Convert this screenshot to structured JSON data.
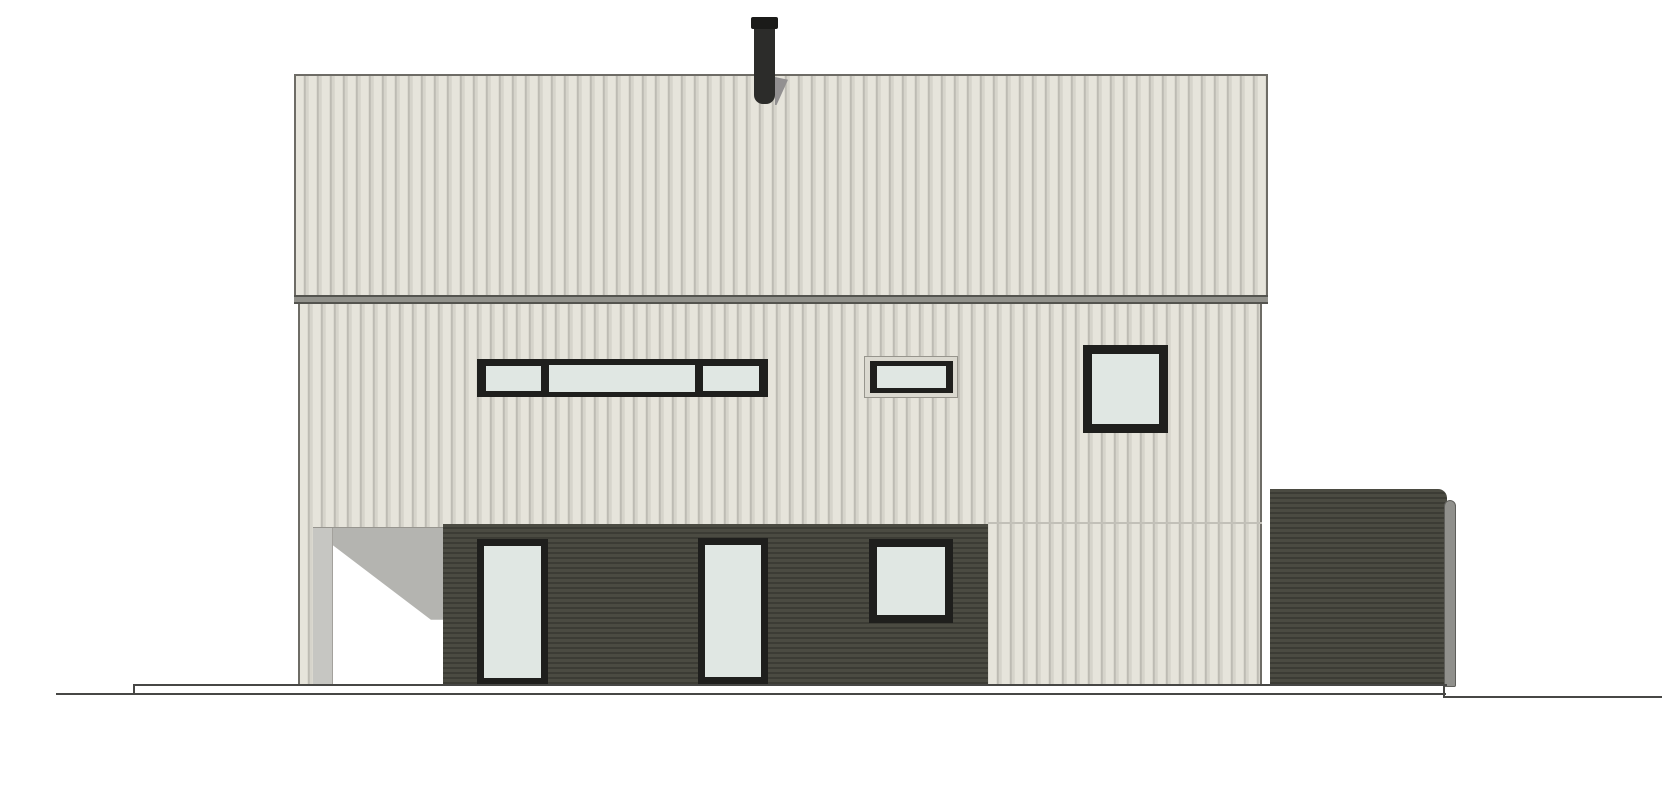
{
  "meta": {
    "domain": "Diagram",
    "drawing_type": "architectural elevation drawing — side facade of a two-storey house",
    "visible_text": []
  },
  "palette": {
    "paper": "#ffffff",
    "siding_light": "#e6e4db",
    "siding_stripe_dark": "#bdbbb3",
    "siding_stripe_mid": "#d6d4cb",
    "trim_edge": "#6e6c66",
    "eave_fill": "#92928c",
    "eave_line": "#54544f",
    "cladding_dark": "#4b4b42",
    "cladding_dark_line": "#3c3c35",
    "frame_dark": "#1f1f1d",
    "glass": "#e0e7e3",
    "casing_light": "#dbd9d0",
    "soffit_gray": "#b4b4b0",
    "soffit_gray_light": "#c6c6c2",
    "opening_white": "#ffffff",
    "chimney_body": "#2c2c2a",
    "chimney_cap": "#1b1b19",
    "chimney_shadow": "#929091",
    "pipe_gray": "#90908c",
    "pipe_edge": "#5f5f5b",
    "ground_line": "#474745",
    "floor_line_faint": "#c2c0b8"
  },
  "elevation": {
    "canvas_px": {
      "width": 1670,
      "height": 800
    },
    "storeys": 2,
    "parts": {
      "chimney": {
        "kind": "flue pipe with cap",
        "position": "top centre of roof"
      },
      "roof_band": {
        "kind": "upper fascia band",
        "finish": "light vertical siding"
      },
      "eave_band": {
        "kind": "horizontal eave trim band"
      },
      "upper_wall": {
        "finish": "light vertical siding",
        "windows": [
          {
            "kind": "horizontal strip window",
            "panes": 3
          },
          {
            "kind": "small rectangular window with light casing",
            "panes": 1
          },
          {
            "kind": "square window",
            "panes": 1
          }
        ]
      },
      "ground_floor": {
        "finish": "dark horizontal cladding",
        "openings": [
          {
            "kind": "full-height glazed door",
            "count": 2
          },
          {
            "kind": "square window",
            "count": 1
          }
        ],
        "carport_recess": {
          "kind": "open passage under left side",
          "shading": "gray soffit with diagonal shadow over white opening"
        }
      },
      "annex": {
        "kind": "low dark flat-roofed volume at right",
        "accessories": [
          "downpipe with curved top"
        ]
      },
      "ground": {
        "kind": "foundation line and terrain line",
        "terrain_step": "slight step down right of annex"
      }
    }
  },
  "labels": {
    "drawing": "House facade elevation",
    "chimney": "Chimney flue",
    "roof_band": "Roof fascia band",
    "eave": "Eave trim band",
    "upper_wall": "Upper wall siding",
    "strip_window": "Horizontal strip window",
    "vent_window": "Small rectangular window",
    "upper_square_window": "Square upper window",
    "carport": "Open carport recess",
    "ground_floor": "Dark clad ground floor",
    "door_left": "Glazed door (left)",
    "door_right": "Glazed door (right)",
    "ground_window": "Square ground-floor window",
    "annex": "Dark annex volume",
    "downpipe": "Downpipe",
    "foundation": "Foundation line",
    "terrain": "Terrain line"
  }
}
